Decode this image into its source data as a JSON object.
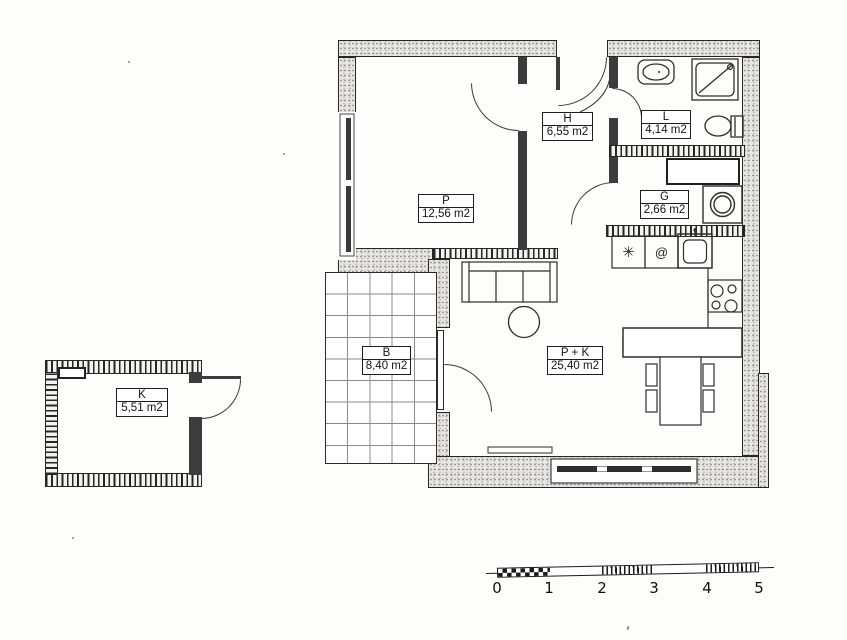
{
  "plan": {
    "rooms": [
      {
        "key": "P",
        "label": "P",
        "area": "12,56 m2"
      },
      {
        "key": "H",
        "label": "H",
        "area": "6,55 m2"
      },
      {
        "key": "L",
        "label": "L",
        "area": "4,14 m2"
      },
      {
        "key": "G",
        "label": "G",
        "area": "2,66 m2"
      },
      {
        "key": "PK",
        "label": "P + K",
        "area": "25,40 m2"
      },
      {
        "key": "B",
        "label": "B",
        "area": "8,40 m2"
      },
      {
        "key": "K",
        "label": "K",
        "area": "5,51 m2"
      }
    ],
    "kitchen_symbols": {
      "appliance_star": "✳",
      "appliance_spiral": "@"
    },
    "scale_bar": {
      "tick_labels": [
        "0",
        "1",
        "2",
        "3",
        "4",
        "5"
      ]
    },
    "colors": {
      "ink": "#2a2a2a",
      "wall_fill": "#e7e6e2",
      "paper": "#fdfdfc",
      "window_band": "#2e2e2e"
    }
  }
}
